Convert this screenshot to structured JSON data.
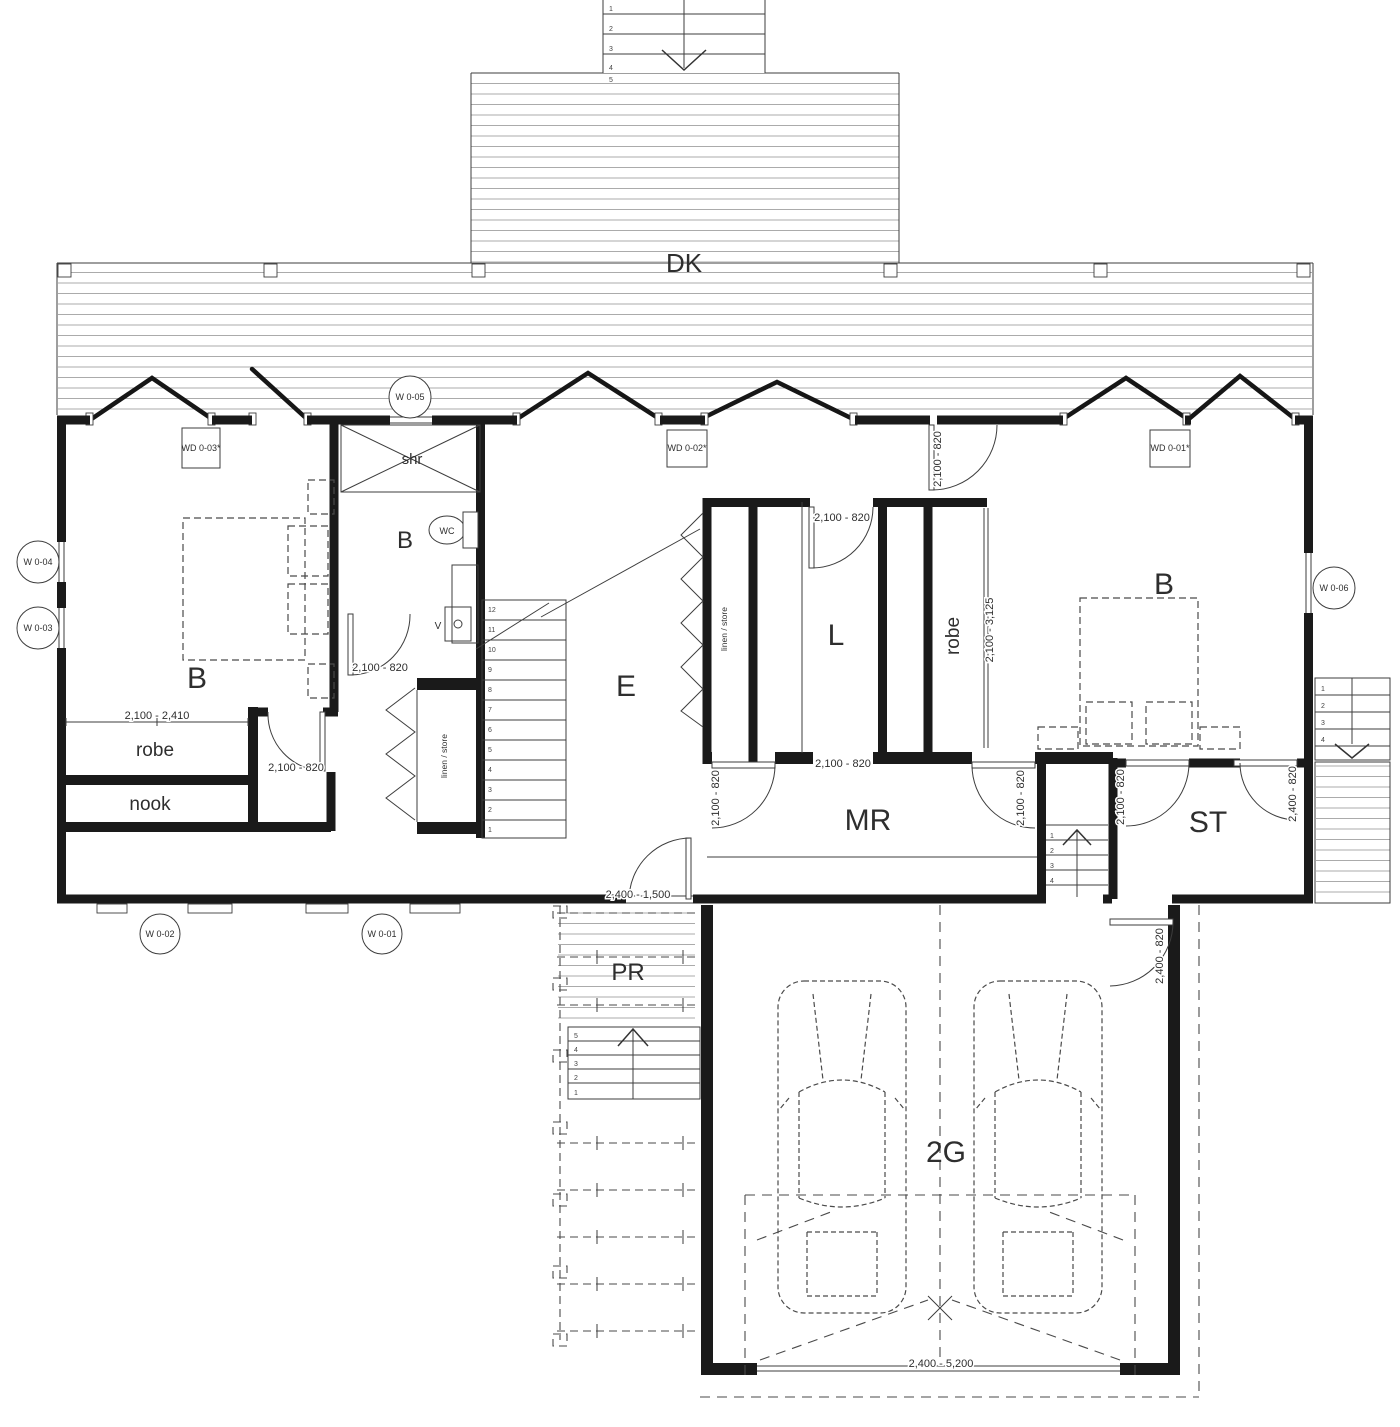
{
  "rooms": {
    "deck": "DK",
    "bedroom_left": "B",
    "bathroom": "B",
    "entry": "E",
    "living": "L",
    "bedroom_right": "B",
    "mud_room": "MR",
    "store": "ST",
    "porch": "PR",
    "garage": "2G"
  },
  "fixtures": {
    "shower": "shr",
    "toilet": "WC",
    "vanity": "V",
    "robe": "robe",
    "nook": "nook",
    "linen_hall": "linen / store",
    "linen_inner": "linen / store",
    "robe_inner": "robe"
  },
  "dimensions": {
    "robe_opening": "2,100 - 2,410",
    "bedroom_left_door": "2,100 - 820",
    "bathroom_door": "2,100 - 820",
    "living_door": "2,100 - 820",
    "bedroom_right_door": "2,100 - 820",
    "hall_opening": "2,100 - 820",
    "mudroom_left_door": "2,100 - 820",
    "mudroom_right_door": "2,100 - 820",
    "store_left_door": "2,100 - 820",
    "store_right_door": "2,400 - 820",
    "garage_entry_door": "2,400 - 820",
    "robe_right_sliding": "2,100 - 3,125",
    "entry_door": "2,400 - 1,500",
    "garage_door": "2,400 - 5,200"
  },
  "tags": {
    "wd03": "WD 0-03*",
    "wd02": "WD 0-02*",
    "wd01": "WD 0-01*",
    "w05": "W 0-05",
    "w04": "W 0-04",
    "w03": "W 0-03",
    "w06": "W 0-06",
    "w02": "W 0-02",
    "w01": "W 0-01"
  },
  "stairs": {
    "main": [
      "12",
      "11",
      "10",
      "9",
      "8",
      "7",
      "6",
      "5",
      "4",
      "3",
      "2",
      "1"
    ],
    "top": [
      "1",
      "2",
      "3",
      "4",
      "5"
    ],
    "right": [
      "1",
      "2",
      "3",
      "4"
    ],
    "porch": [
      "5",
      "4",
      "3",
      "2",
      "1"
    ],
    "garage_side": [
      "1",
      "2",
      "3",
      "4"
    ]
  }
}
